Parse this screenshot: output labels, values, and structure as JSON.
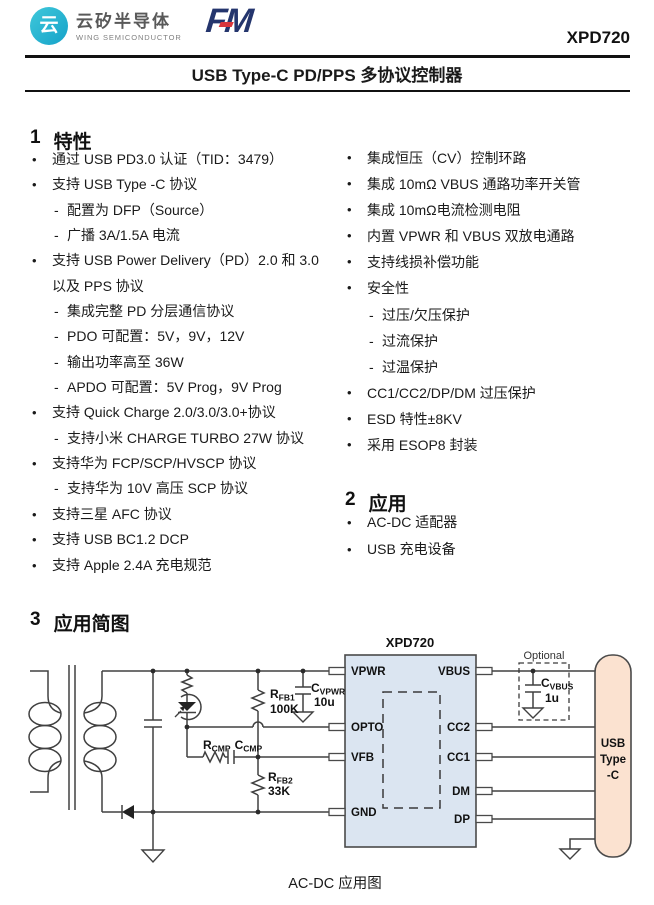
{
  "header": {
    "logo_glyph": "云",
    "brand_cn": "云矽半导体",
    "brand_en": "WING SEMICONDUCTOR",
    "fm_f": "F",
    "fm_m": "M",
    "part_number": "XPD720",
    "title": "USB Type-C PD/PPS 多协议控制器"
  },
  "sections": {
    "features": {
      "num": "1",
      "title": "特性"
    },
    "applications": {
      "num": "2",
      "title": "应用"
    },
    "diagram": {
      "num": "3",
      "title": "应用简图"
    }
  },
  "features_left": [
    {
      "type": "main",
      "marker": "•",
      "text": "通过 USB PD3.0 认证（TID：3479）"
    },
    {
      "type": "main",
      "marker": "•",
      "text": "支持 USB Type -C 协议"
    },
    {
      "type": "sub",
      "marker": "-",
      "text": "配置为 DFP（Source）"
    },
    {
      "type": "sub",
      "marker": "-",
      "text": "广播 3A/1.5A 电流"
    },
    {
      "type": "main",
      "marker": "•",
      "text": "支持 USB Power Delivery（PD）2.0 和 3.0"
    },
    {
      "type": "cont",
      "marker": "",
      "text": "以及 PPS 协议"
    },
    {
      "type": "sub",
      "marker": "-",
      "text": "集成完整 PD 分层通信协议"
    },
    {
      "type": "sub",
      "marker": "-",
      "text": "PDO 可配置：5V，9V，12V"
    },
    {
      "type": "sub",
      "marker": "-",
      "text": "输出功率高至 36W"
    },
    {
      "type": "sub",
      "marker": "-",
      "text": "APDO 可配置：5V Prog，9V Prog"
    },
    {
      "type": "main",
      "marker": "•",
      "text": "支持 Quick Charge 2.0/3.0/3.0+协议"
    },
    {
      "type": "sub",
      "marker": "-",
      "text": "支持小米 CHARGE TURBO 27W 协议"
    },
    {
      "type": "main",
      "marker": "•",
      "text": "支持华为 FCP/SCP/HVSCP 协议"
    },
    {
      "type": "sub",
      "marker": "-",
      "text": "支持华为 10V 高压 SCP 协议"
    },
    {
      "type": "main",
      "marker": "•",
      "text": "支持三星 AFC 协议"
    },
    {
      "type": "main",
      "marker": "•",
      "text": "支持 USB BC1.2 DCP"
    },
    {
      "type": "main",
      "marker": "•",
      "text": "支持 Apple 2.4A 充电规范"
    }
  ],
  "features_right": [
    {
      "type": "main",
      "marker": "•",
      "text": "集成恒压（CV）控制环路"
    },
    {
      "type": "main",
      "marker": "•",
      "text": "集成 10mΩ VBUS 通路功率开关管"
    },
    {
      "type": "main",
      "marker": "•",
      "text": "集成 10mΩ电流检测电阻"
    },
    {
      "type": "main",
      "marker": "•",
      "text": "内置 VPWR 和 VBUS 双放电通路"
    },
    {
      "type": "main",
      "marker": "•",
      "text": "支持线损补偿功能"
    },
    {
      "type": "main",
      "marker": "•",
      "text": "安全性"
    },
    {
      "type": "sub",
      "marker": "-",
      "text": "过压/欠压保护"
    },
    {
      "type": "sub",
      "marker": "-",
      "text": "过流保护"
    },
    {
      "type": "sub",
      "marker": "-",
      "text": "过温保护"
    },
    {
      "type": "main",
      "marker": "•",
      "text": "CC1/CC2/DP/DM 过压保护"
    },
    {
      "type": "main",
      "marker": "•",
      "text": "ESD 特性±8KV"
    },
    {
      "type": "main",
      "marker": "•",
      "text": "采用 ESOP8 封装"
    }
  ],
  "applications_items": [
    {
      "type": "main",
      "marker": "•",
      "text": "AC-DC 适配器"
    },
    {
      "type": "main",
      "marker": "•",
      "text": "USB 充电设备"
    }
  ],
  "schematic": {
    "ic_name": "XPD720",
    "pins_left": [
      "VPWR",
      "OPTO",
      "VFB",
      "GND"
    ],
    "pins_right": [
      "VBUS",
      "CC2",
      "CC1",
      "DM",
      "DP"
    ],
    "optional_label": "Optional",
    "connector": {
      "line1": "USB",
      "line2": "Type",
      "line3": "-C"
    },
    "components": {
      "c_vpwr": {
        "sym": "C",
        "sub": "VPWR",
        "val": "10u"
      },
      "r_fb1": {
        "sym": "R",
        "sub": "FB1",
        "val": "100K"
      },
      "r_cmp": {
        "sym": "R",
        "sub": "CMP"
      },
      "c_cmp": {
        "sym": "C",
        "sub": "CMP"
      },
      "r_fb2": {
        "sym": "R",
        "sub": "FB2",
        "val": "33K"
      },
      "c_vbus": {
        "sym": "C",
        "sub": "VBUS",
        "val": "1u"
      }
    },
    "caption": "AC-DC 应用图"
  },
  "colors": {
    "brand_teal": "#1fb4cf",
    "fm_navy": "#24356d",
    "fm_red": "#d9363c",
    "ic_fill": "#dbe5f1",
    "connector_fill": "#fbe2d0",
    "line": "#404040",
    "text": "#1a1a1a"
  }
}
